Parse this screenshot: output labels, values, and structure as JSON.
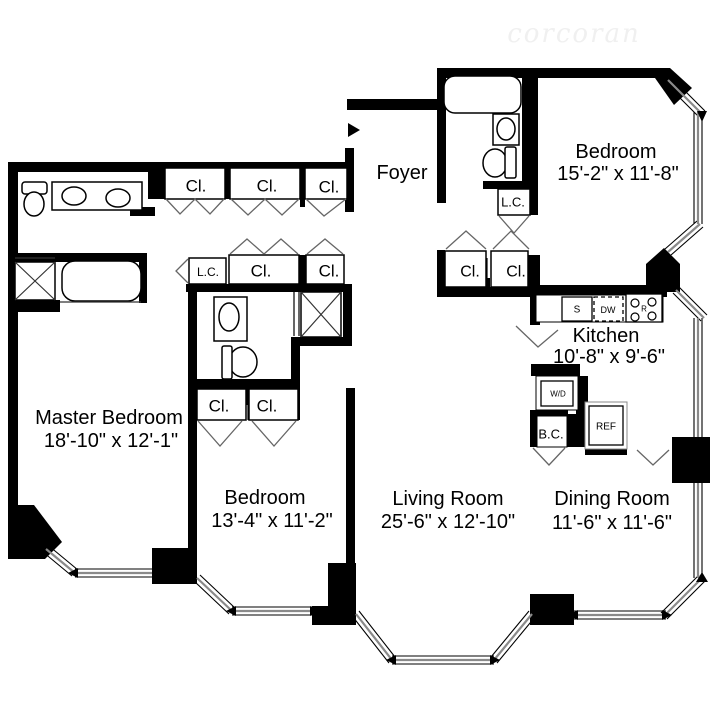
{
  "watermark": "corcoran",
  "labels": {
    "closet": "Cl.",
    "linen_closet": "L.C.",
    "broom_closet": "B.C."
  },
  "appliances": {
    "sink": "S",
    "dishwasher": "DW",
    "range": "R",
    "washer_dryer": "W/D",
    "refrigerator": "REF"
  },
  "rooms": {
    "foyer": {
      "name": "Foyer"
    },
    "bedroom_top": {
      "name": "Bedroom",
      "dims": "15'-2\" x 11'-8\""
    },
    "kitchen": {
      "name": "Kitchen",
      "dims": "10'-8\" x 9'-6\""
    },
    "master_bedroom": {
      "name": "Master Bedroom",
      "dims": "18'-10\" x 12'-1\""
    },
    "bedroom_bottom": {
      "name": "Bedroom",
      "dims": "13'-4\" x 11'-2\""
    },
    "living_room": {
      "name": "Living Room",
      "dims": "25'-6\" x 12'-10\""
    },
    "dining_room": {
      "name": "Dining Room",
      "dims": "11'-6\" x 11'-6\""
    }
  },
  "colors": {
    "wall": "#000000",
    "background": "#ffffff",
    "window_glass": "#8a8a8a",
    "door_swing": "#666666",
    "watermark": "#f0f0f0"
  }
}
